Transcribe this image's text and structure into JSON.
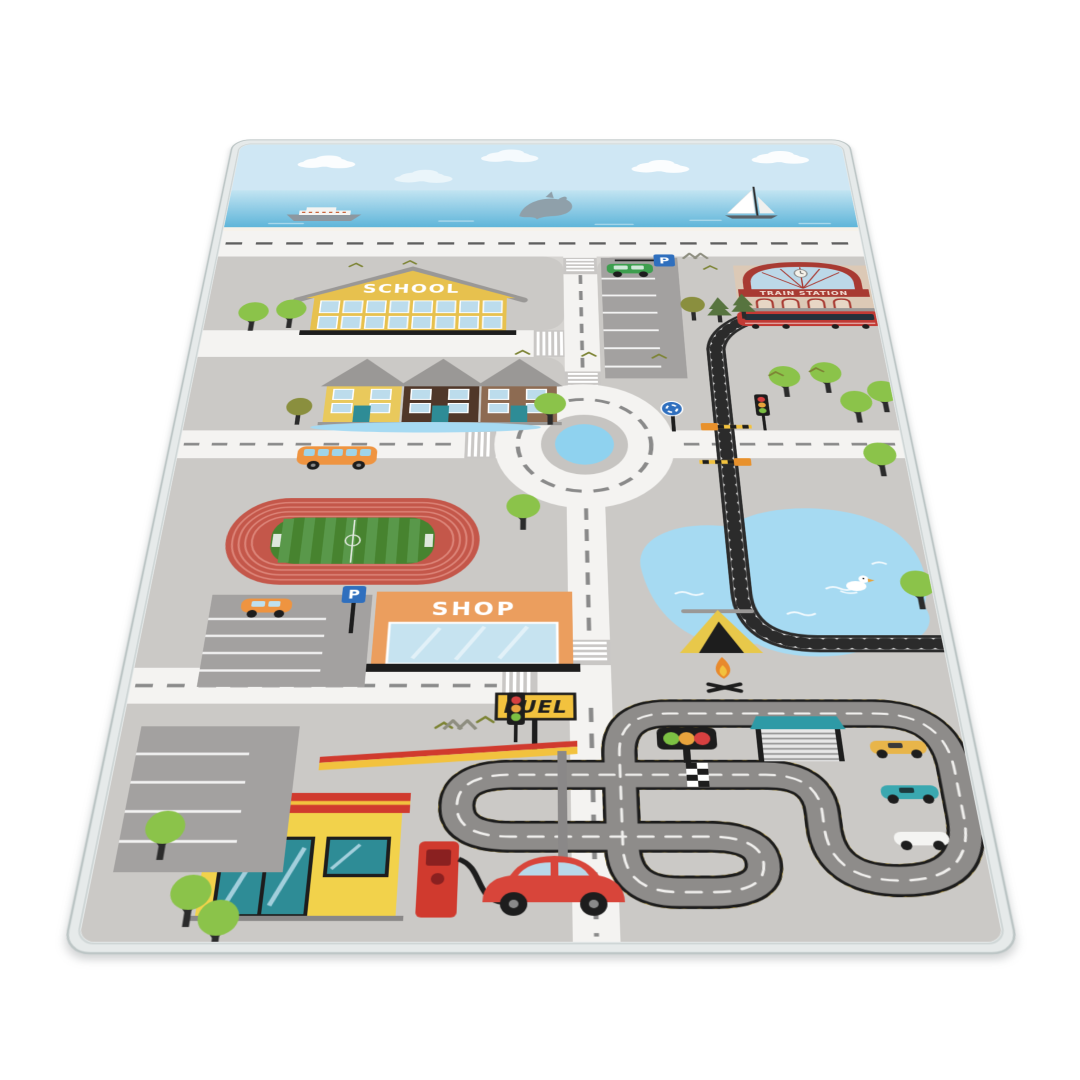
{
  "scene": {
    "type": "product-photo",
    "subject": "children's city road play rug shown at an angle on a white background"
  },
  "rug": {
    "labels": {
      "school": "SCHOOL",
      "train_station": "TRAIN STATION",
      "shop": "SHOP",
      "fuel": "FUEL",
      "parking_sign": "P"
    },
    "colors": {
      "sky": "#cfe7f4",
      "sea_top": "#bfe3f2",
      "sea_bottom": "#5fb5d9",
      "city_base": "#d6d4d1",
      "block": "#cbc9c6",
      "road": "#f4f3f1",
      "road_dash": "#8a8a8a",
      "edge_binding": "#e6eaea",
      "school_yellow": "#e7c14e",
      "station_red": "#a83a32",
      "station_beige": "#dcc9b6",
      "house_yellow": "#e9c95c",
      "house_dark_brown": "#503729",
      "house_brown": "#8d6b52",
      "roof_gray": "#9a9896",
      "shop_orange": "#eb9e5e",
      "fuel_yellow": "#f2d24b",
      "fuel_red": "#d03a2e",
      "stadium_track_red": "#c4574a",
      "field_green": "#47832f",
      "lake_blue": "#a6daf2",
      "roundabout_pond": "#8fd2ef",
      "race_track_gray": "#8e8c8a",
      "hazard_yellow": "#caa72e",
      "parking_gray": "#a3a1a0",
      "tree_green": "#8bc34a",
      "bus_orange": "#ef9440",
      "car_red": "#d8453a",
      "train_red": "#c23a34",
      "sign_blue": "#2f6fbe"
    },
    "scene_elements": [
      "sea with cruise ship, jumping dolphin and sailboat",
      "coastal road with dashed center line",
      "school building",
      "train station with clock and red train",
      "curved railway track with level crossing",
      "three houses with pond",
      "roundabout with blue pond center",
      "parking lots with P signs and cars",
      "orange bus",
      "athletics stadium with football field",
      "shop building",
      "lake with duck",
      "camping tent with campfire",
      "go-kart race track with garage, start lights, checkered line and race cars",
      "fuel station with pump and red car",
      "trees, birds and mountains"
    ]
  }
}
